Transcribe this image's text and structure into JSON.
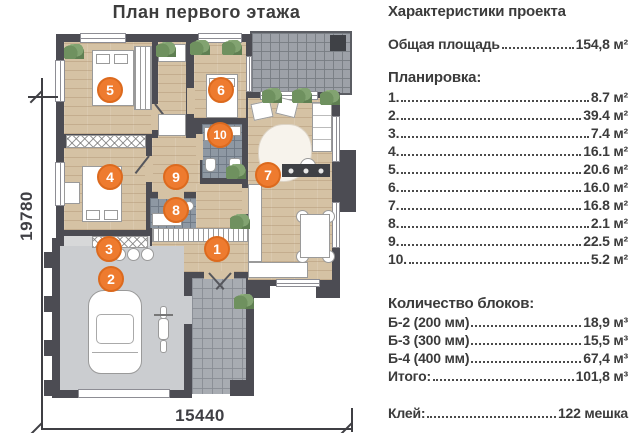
{
  "title": "План первого этажа",
  "dimensions": {
    "bottom": "15440",
    "left": "19780"
  },
  "panel": {
    "heading": "Характеристики проекта",
    "total_area": {
      "label": "Общая площадь",
      "value": "154,8 м²"
    },
    "planning_heading": "Планировка:",
    "planning": [
      {
        "num": "1.",
        "value": "8.7 м²"
      },
      {
        "num": "2.",
        "value": "39.4 м²"
      },
      {
        "num": "3.",
        "value": "7.4 м²"
      },
      {
        "num": "4.",
        "value": "16.1 м²"
      },
      {
        "num": "5.",
        "value": "20.6 м²"
      },
      {
        "num": "6.",
        "value": "16.0 м²"
      },
      {
        "num": "7.",
        "value": "16.8 м²"
      },
      {
        "num": "8.",
        "value": "2.1 м²"
      },
      {
        "num": "9.",
        "value": "22.5 м²"
      },
      {
        "num": "10.",
        "value": "5.2 м²"
      }
    ],
    "blocks_heading": "Количество блоков:",
    "blocks": [
      {
        "label": "Б-2 (200 мм)",
        "value": "18,9 м³"
      },
      {
        "label": "Б-3 (300 мм)",
        "value": "15,5 м³"
      },
      {
        "label": "Б-4 (400 мм)",
        "value": "67,4 м³"
      }
    ],
    "blocks_total": {
      "label": "Итого:",
      "value": "101,8 м³"
    },
    "glue": {
      "label": "Клей:",
      "value": "122 мешка"
    }
  },
  "markers": [
    "1",
    "2",
    "3",
    "4",
    "5",
    "6",
    "7",
    "8",
    "9",
    "10"
  ],
  "colors": {
    "marker": "#ee7b2f",
    "wall": "#4c4c53",
    "wood": "#d5c2a4"
  }
}
